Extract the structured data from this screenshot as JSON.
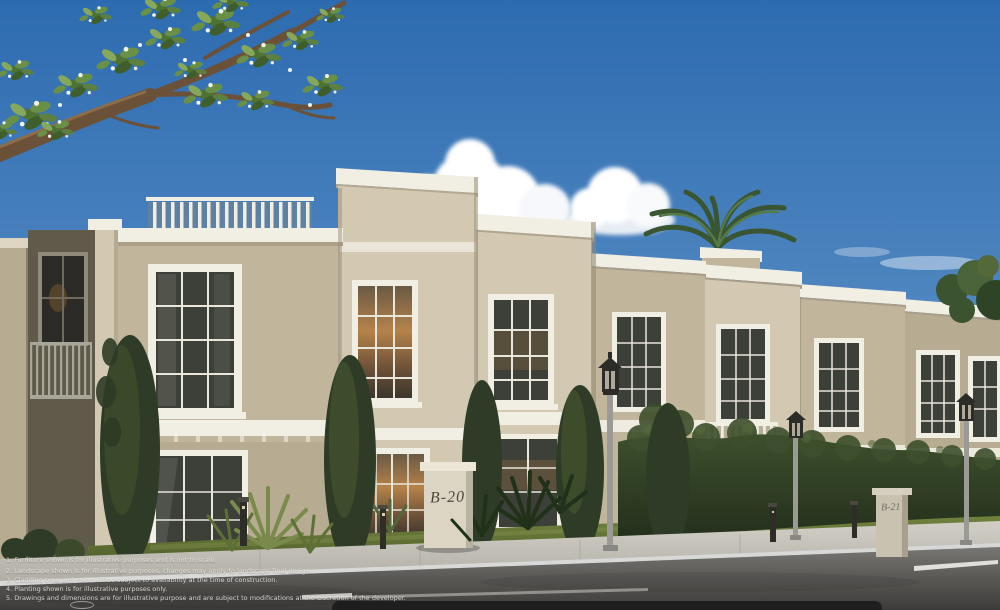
{
  "signs": {
    "unit_b20": "B-20",
    "unit_b21": "B-21"
  },
  "disclaimers": [
    "1. Furniture shown is for illustrative purposes and is not to scale.",
    "2. Landscape shown is for illustrative purposes, changes may apply to landscape final design.",
    "3. Cladding type and color will be subject to availability at the time of construction.",
    "4. Planting shown is for illustrative purposes only.",
    "5. Drawings and dimensions are for illustrative purpose and are subject to modifications at the discretion of the developer."
  ],
  "palette": {
    "sky-top": "#2d6bb0",
    "sky-horizon": "#b9cede",
    "cloud": "#ffffff",
    "wall-light": "#d3c9b2",
    "wall-mid": "#c1b69c",
    "wall-shadow": "#8e8470",
    "wall-dark": "#5f5a49",
    "trim": "#f1eee4",
    "glass-cool": "#3c4038",
    "glass-warm": "#a87844",
    "hedge": "#2e3b26",
    "lawn": "#5e6e33",
    "sidewalk": "#c5c3bc",
    "road": "#4c4b49",
    "lane-marking": "#e8e6e1",
    "bottom-bar": "#1c1c1c",
    "sign-text": "#4a4538"
  }
}
